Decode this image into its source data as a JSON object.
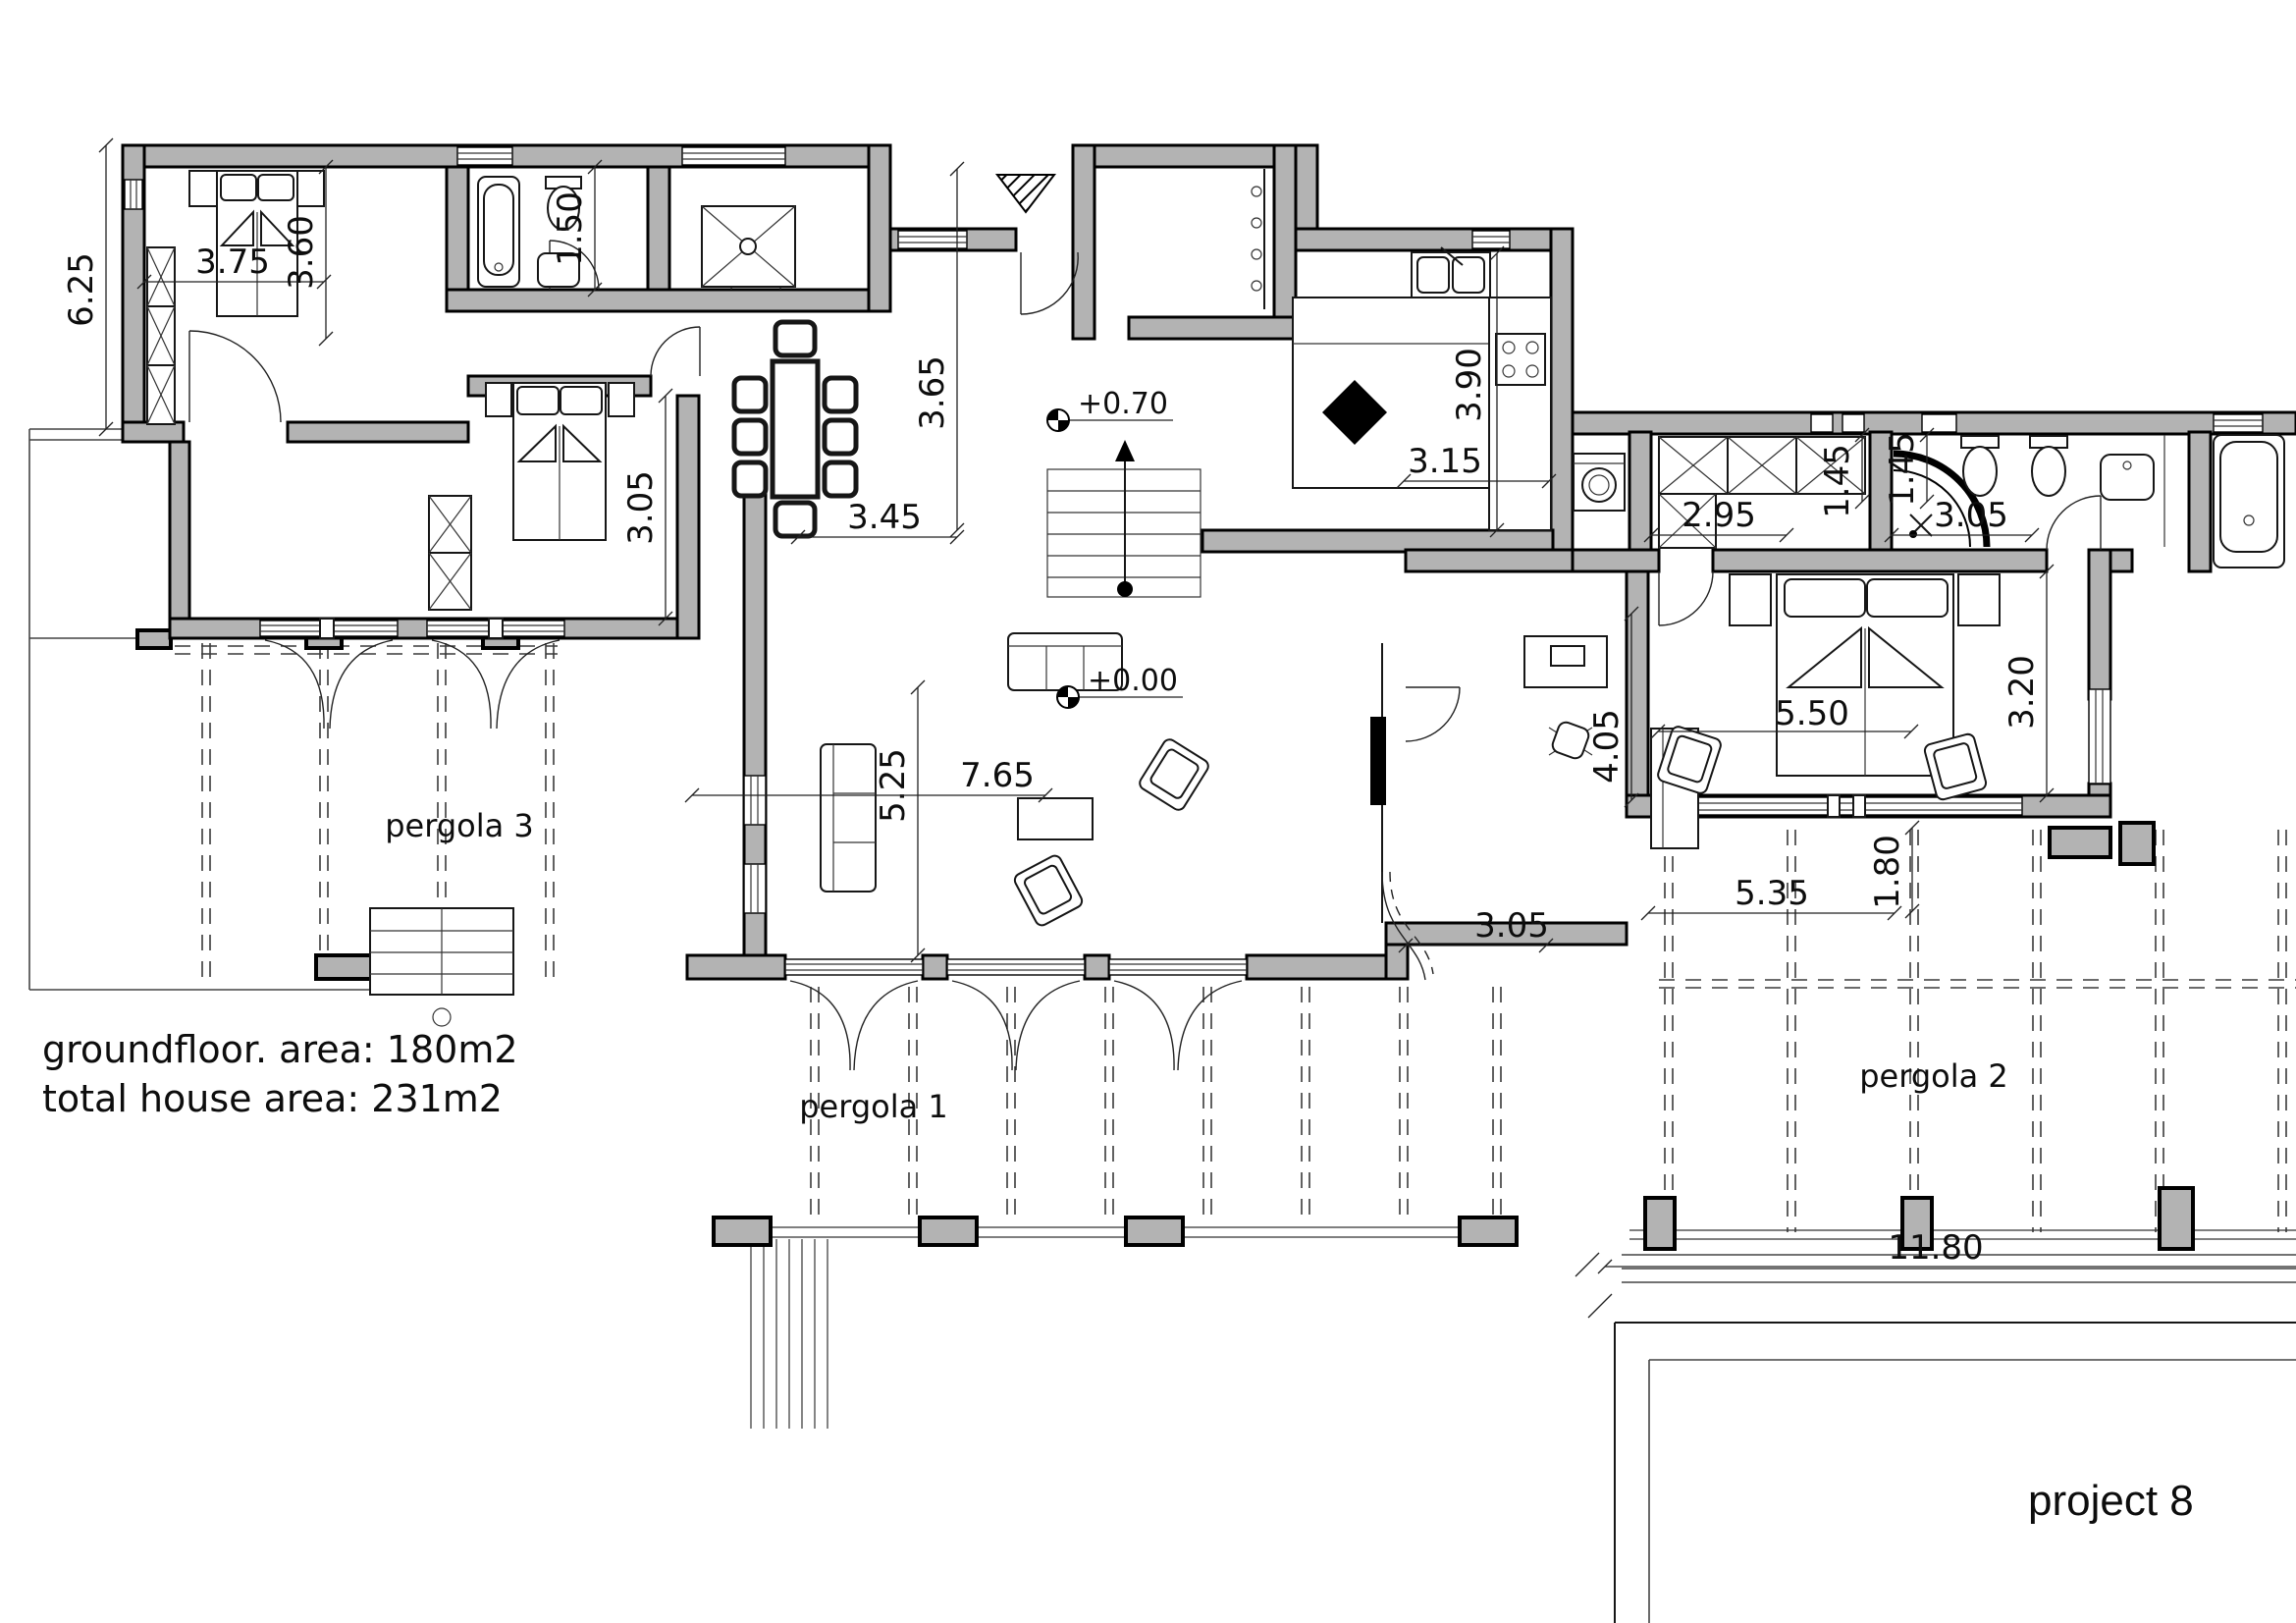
{
  "project": {
    "name": "project 8"
  },
  "areas": {
    "groundfloor": "groundfloor. area: 180m2",
    "total": "total house area: 231m2"
  },
  "pergolas": {
    "p1": "pergola 1",
    "p2": "pergola 2",
    "p3": "pergola 3"
  },
  "levels": {
    "entry": "+0.70",
    "living": "+0.00"
  },
  "dims": {
    "facade_left": "6.25",
    "bed1_w": "3.75",
    "bed1_h": "3.60",
    "bath1_h": "1.50",
    "bed2_h": "3.05",
    "dining_h": "3.65",
    "dining_w": "3.45",
    "kitchen_h": "3.90",
    "kitchen_w": "3.15",
    "living_h": "5.25",
    "living_w": "7.65",
    "study_h": "4.05",
    "study_w": "3.05",
    "wardrobe_w": "2.95",
    "wardrobe_h": "1.45",
    "mbath_h": "1.45",
    "mbath_w": "3.05",
    "mbed_w": "5.50",
    "mbed_h": "3.20",
    "terrace_w": "5.35",
    "terrace_h": "1.80",
    "pergola2_w": "11.80"
  }
}
